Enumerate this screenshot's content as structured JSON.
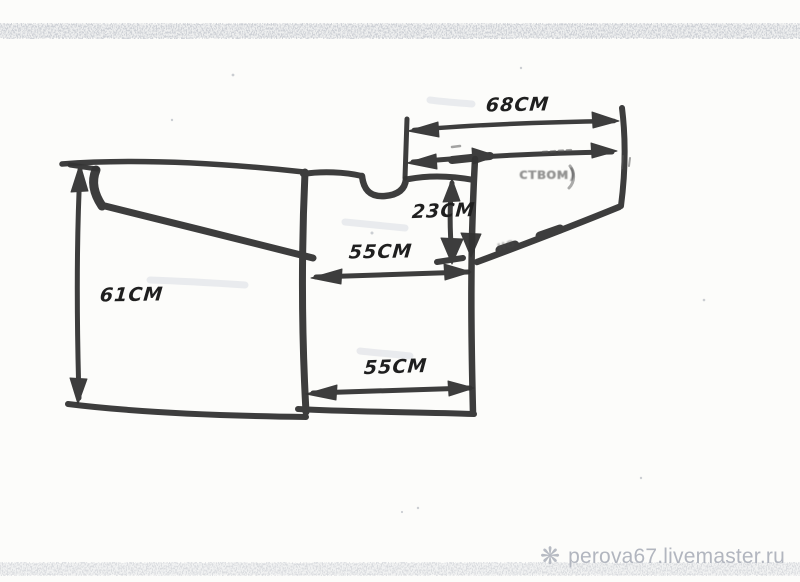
{
  "diagram": {
    "ink_color": "#333333",
    "measurements": {
      "sleeve_span": "68см",
      "armhole_depth": "23см",
      "chest_width": "55см",
      "hem_width": "55см",
      "body_length": "61см"
    },
    "erased_notes": {
      "note_top": "ством)",
      "note_diagonal": "но"
    }
  },
  "watermark": {
    "icon_glyph": "❋",
    "text": "perova67.livemaster.ru",
    "color": "#b2b6bf"
  }
}
